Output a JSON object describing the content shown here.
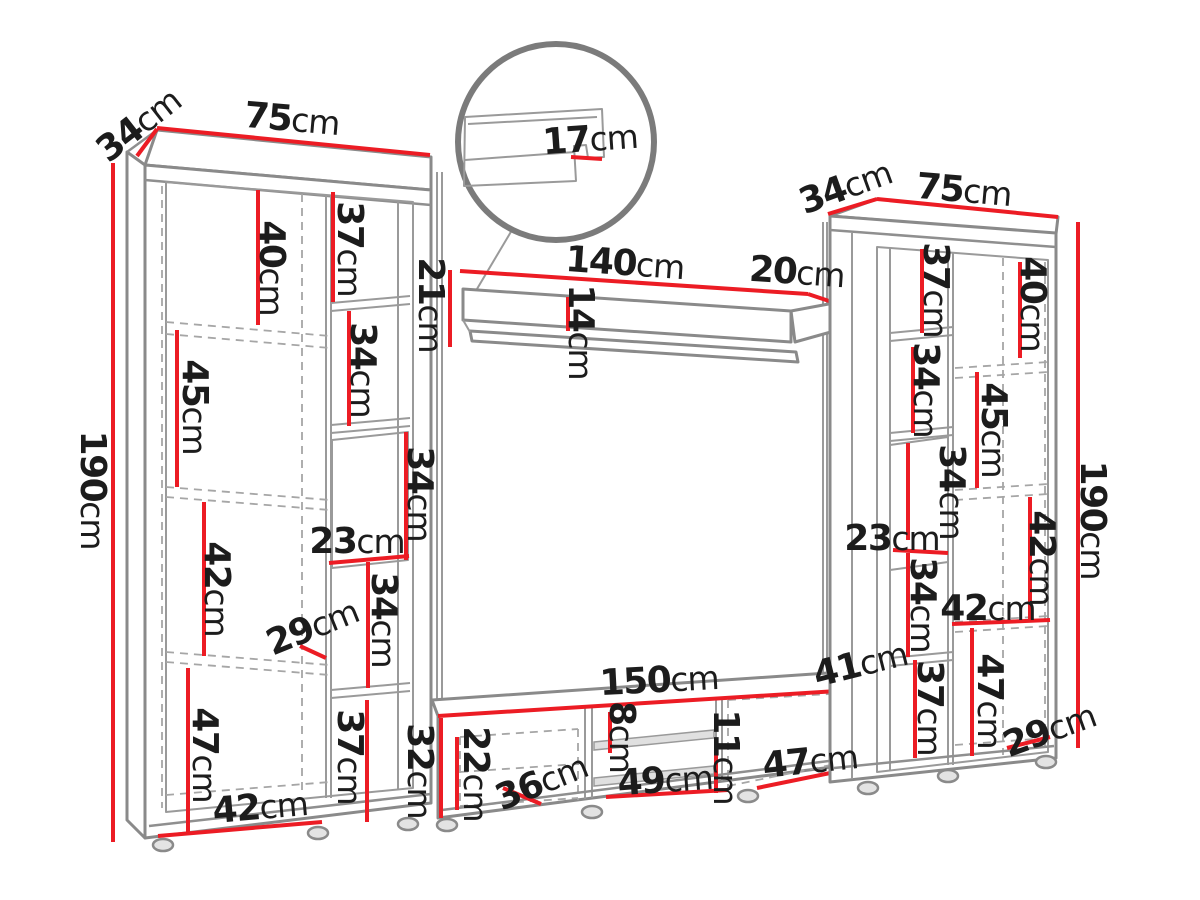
{
  "diagram_type": "furniture-dimension-drawing",
  "subject": "TV wall unit: two tall cabinets, wall shelf with magnified lip detail, TV stand",
  "unit": "cm",
  "colors": {
    "dimension_red": "#ec1c24",
    "drawing_gray": "#8a8a8a",
    "label_text": "#1c1c1c",
    "background": "#ffffff"
  },
  "dims": {
    "left_cabinet": {
      "depth": "34",
      "width": "75",
      "height": "190",
      "shelf_40": "40",
      "col_37_top": "37",
      "shelf_45": "45",
      "col_34_upper": "34",
      "open_34": "34",
      "col_width_23": "23",
      "shelf_42": "42",
      "depth_29": "29",
      "col_34_lower": "34",
      "shelf_47": "47",
      "col_37_bottom": "37",
      "door_width_42": "42"
    },
    "wall_shelf": {
      "width": "140",
      "depth": "20",
      "height": "21",
      "front_14": "14",
      "lip_17": "17"
    },
    "right_cabinet": {
      "depth": "34",
      "width": "75",
      "height": "190",
      "col_37_top": "37",
      "shelf_40": "40",
      "col_34_upper": "34",
      "shelf_45": "45",
      "open_34": "34",
      "col_width_23": "23",
      "col_34_lower": "34",
      "shelf_42_vertical": "42",
      "shelf_42_width": "42",
      "shelf_47": "47",
      "col_37_bottom": "37",
      "width_29": "29"
    },
    "tv_stand": {
      "width": "150",
      "depth": "41",
      "height": "32",
      "door_height_22": "22",
      "door_width_36": "36",
      "gap_8": "8",
      "shelf_width_49": "49",
      "gap_11": "11",
      "door_width_47": "47"
    }
  }
}
